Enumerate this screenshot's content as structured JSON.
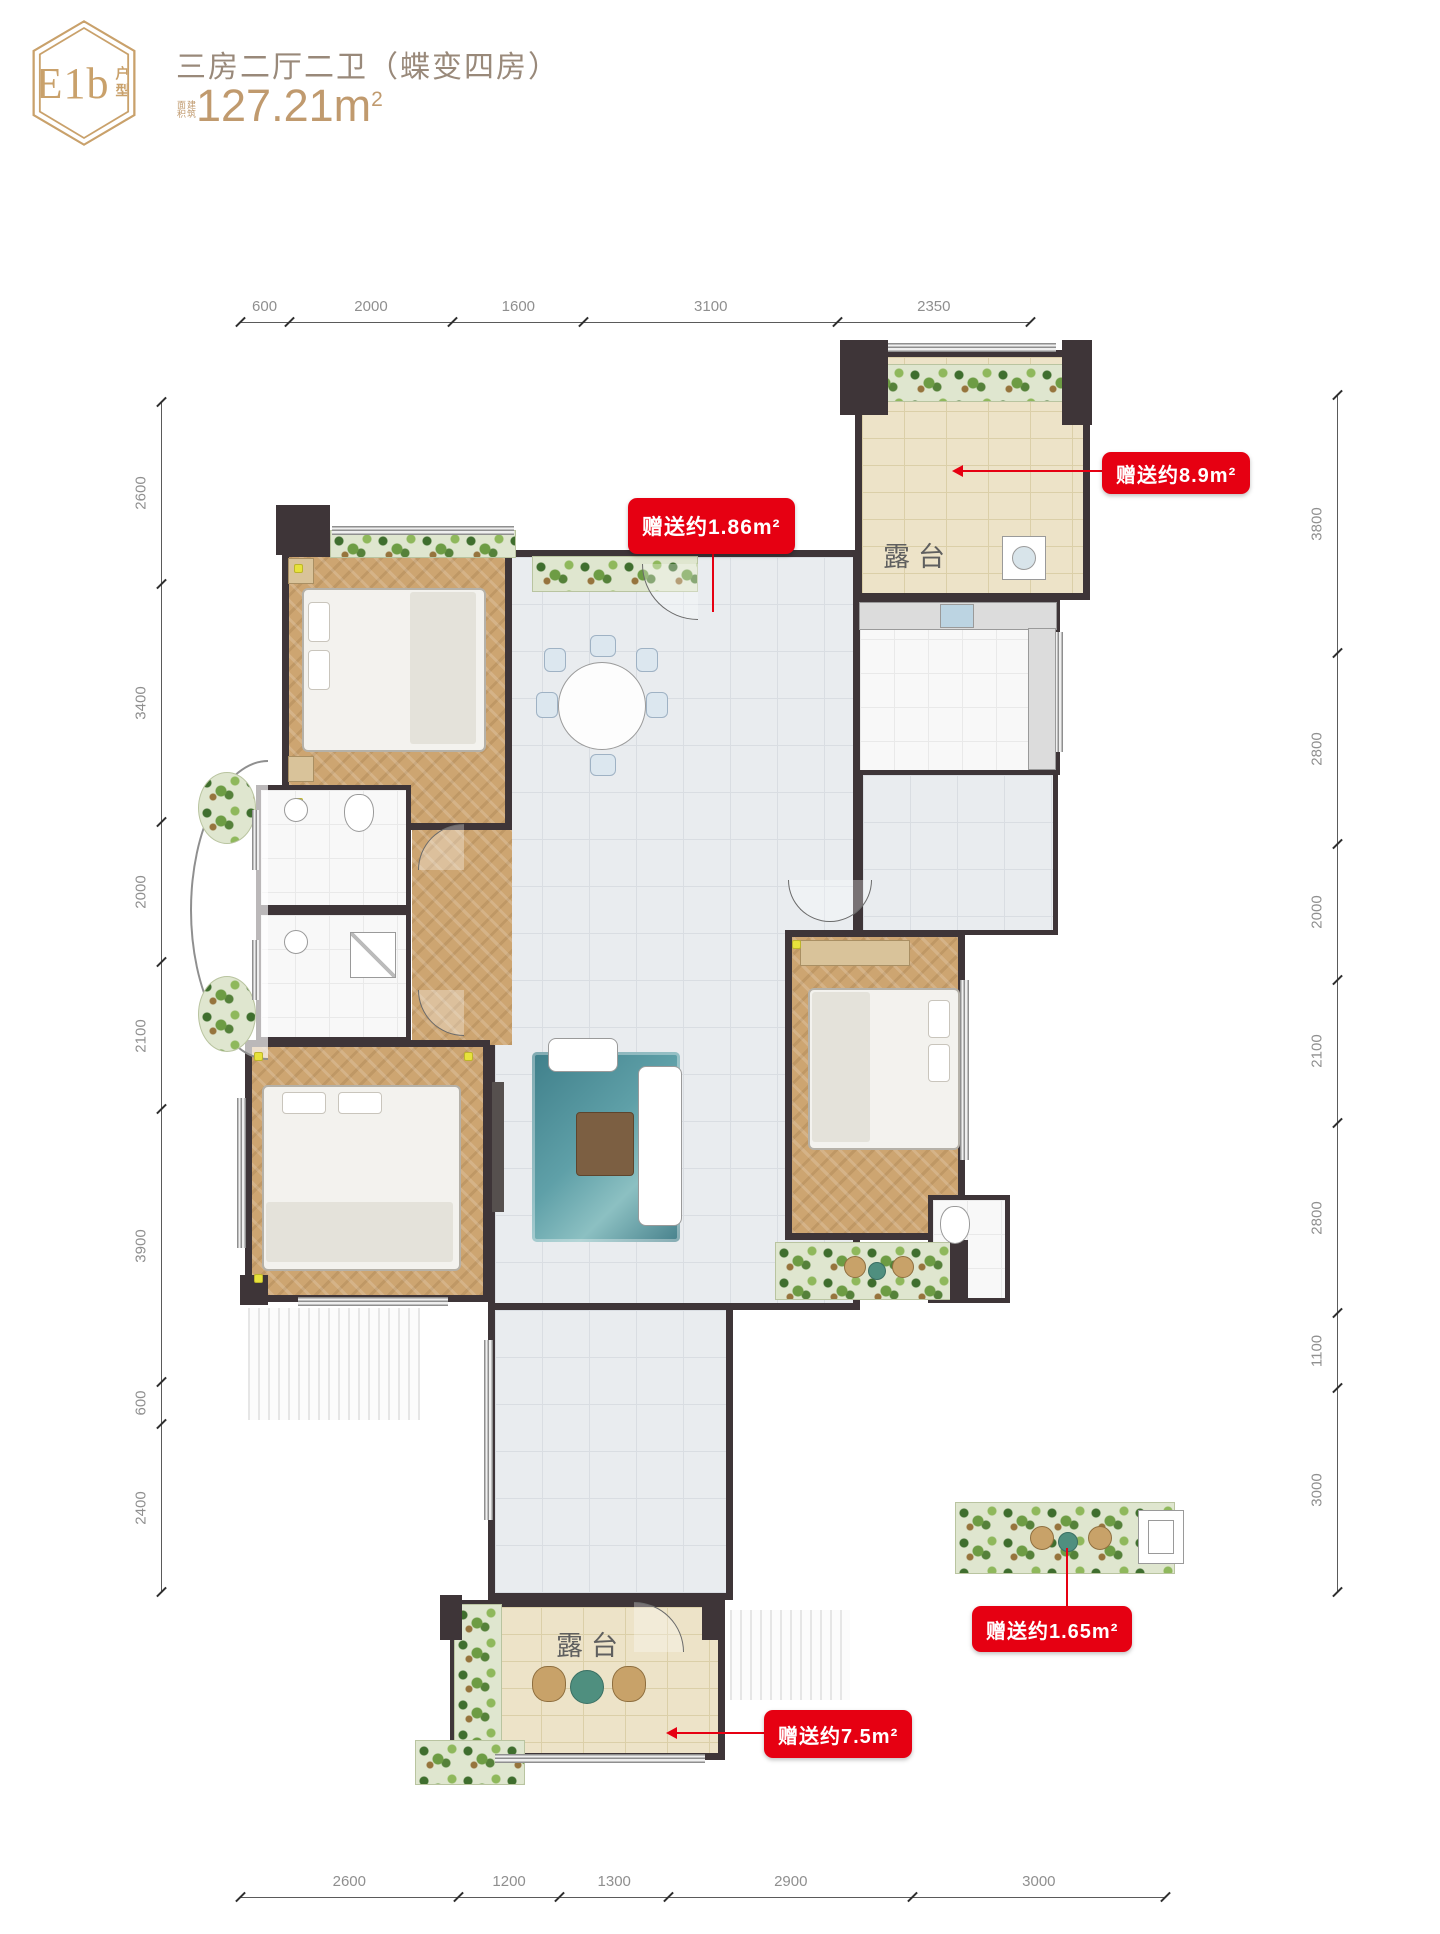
{
  "header": {
    "badge_code": "E1b",
    "badge_suffix": "户型",
    "title": "三房二厅二卫（蝶变四房）",
    "area_prefix": "建筑面积",
    "area_value": "127.21m",
    "area_sup": "2"
  },
  "plan": {
    "terrace_top_label": "露台",
    "terrace_bottom_label": "露台"
  },
  "callouts": {
    "gift1": "赠送约1.86m²",
    "gift2": "赠送约8.9m²",
    "gift3": "赠送约1.65m²",
    "gift4": "赠送约7.5m²"
  },
  "dimensions": {
    "top": [
      600,
      2000,
      1600,
      3100,
      2350
    ],
    "left": [
      2600,
      3400,
      2000,
      2100,
      3900,
      600,
      2400
    ],
    "right": [
      3800,
      2800,
      2000,
      2100,
      2800,
      1100,
      3000
    ],
    "bottom": [
      2600,
      1200,
      1300,
      2900,
      3000
    ]
  },
  "colors": {
    "accent_red": "#e60012",
    "brand_gold": "#c9a16b"
  }
}
